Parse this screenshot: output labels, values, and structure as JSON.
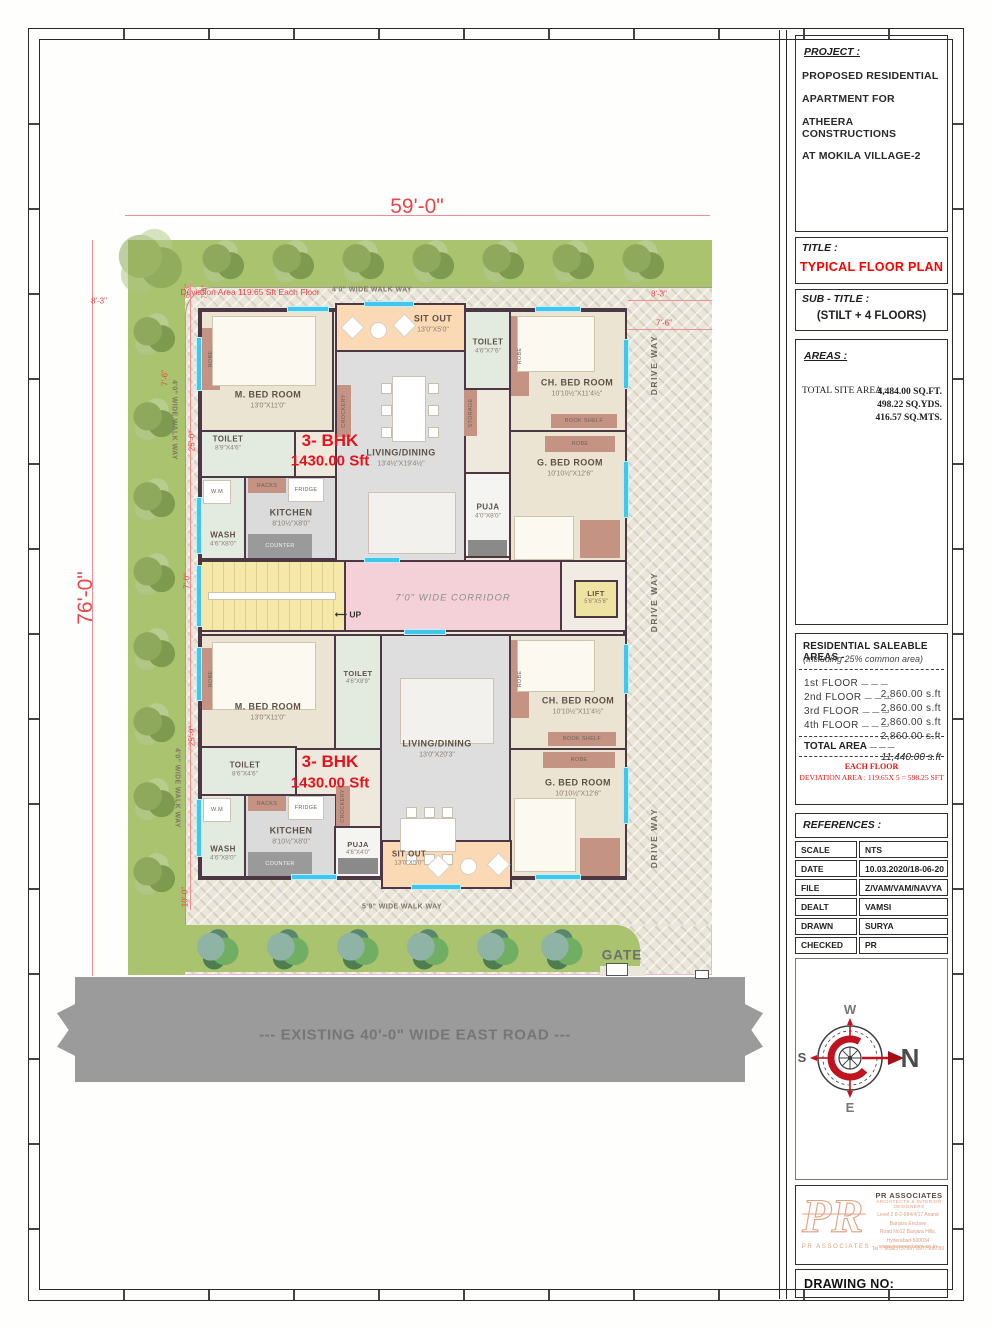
{
  "title_block": {
    "project": {
      "label": "PROJECT :",
      "lines": [
        "PROPOSED RESIDENTIAL",
        "APARTMENT FOR",
        "ATHEERA CONSTRUCTIONS",
        "AT  MOKILA VILLAGE-2"
      ]
    },
    "title": {
      "label": "TITLE :",
      "value": "TYPICAL FLOOR PLAN"
    },
    "subtitle": {
      "label": "SUB - TITLE :",
      "value": "(STILT + 4 FLOORS)"
    },
    "areas": {
      "label": "AREAS :",
      "row_label": "TOTAL SITE AREA :",
      "values": [
        "4,484.00 SQ.FT.",
        "498.22 SQ.YDS.",
        "416.57 SQ.MTS."
      ]
    },
    "saleable": {
      "heading": "RESIDENTIAL SALEABLE  AREAS  -",
      "subheading": "(Including 25% common area)",
      "rows": [
        {
          "floor": "1st   FLOOR",
          "dash": "— — —",
          "area": "2,860.00  s.ft"
        },
        {
          "floor": "2nd  FLOOR",
          "dash": "— — —",
          "area": "2,860.00  s.ft"
        },
        {
          "floor": "3rd  FLOOR",
          "dash": "— — —",
          "area": "2,860.00  s.ft"
        },
        {
          "floor": "4th  FLOOR",
          "dash": "— — —",
          "area": "2,860.00  s.ft"
        }
      ],
      "total_label": "TOTAL  AREA",
      "total_dash": "— — —",
      "total_area": "11,440.00  s.ft",
      "note1": "EACH FLOOR",
      "note2": "DEVIATION AREA  : 119.65X 5 = 598.25 SFT"
    },
    "references": {
      "label": "REFERENCES :",
      "rows": [
        {
          "k": "SCALE",
          "v": "NTS"
        },
        {
          "k": "DATE",
          "v": "10.03.2020/18-06-20"
        },
        {
          "k": "FILE",
          "v": "Z/VAM/VAM/NAVYA"
        },
        {
          "k": "DEALT",
          "v": "VAMSI"
        },
        {
          "k": "DRAWN",
          "v": "SURYA"
        },
        {
          "k": "CHECKED",
          "v": "PR"
        }
      ]
    },
    "compass": {
      "n": "N",
      "s": "S",
      "e": "E",
      "w": "W"
    },
    "firm": {
      "logo": "PR",
      "logo_caption": "PR ASSOCIATES",
      "name": "PR ASSOCIATES",
      "tagline": "ARCHITECTS & INTERIOR DESIGNERS",
      "addr1": "Level 2  8-2-684/4/17 Anand Banjara Enclave",
      "addr2": "Road No12 Banjara Hills, Hyderabad-500034",
      "addr3": "Tel :- 9032573789 / 8977506789",
      "web": "www.prassociates.co.in"
    },
    "drawing_no_label": "DRAWING NO:"
  },
  "plan": {
    "dims": {
      "overall_width": "59'-0\"",
      "overall_height": "76'-0\"",
      "top_inner": "42'-6\"",
      "left_8_3": "8'-3\"",
      "corner_8_3": "8'-3\"",
      "corner_7_6": "7'-6\"",
      "right_8_3": "8'-3\"",
      "right_7_6": "7'-6\"",
      "left_7_6": "7'-6\"",
      "left_25_0": "25'-0\"",
      "left_7_0": "7'-0\"",
      "left_25_9": "25'-9\"",
      "left_10_0": "10'-0\""
    },
    "notes": {
      "deviation": "Deviation Area 119.65 Sft Each Floor"
    },
    "labels": {
      "walkway_top": "4'0\" WIDE WALK WAY",
      "walkway_left": "4'0\" WIDE WALK WAY",
      "walkway_bottom": "5'9\" WIDE WALK WAY",
      "driveway": "DRIVE WAY",
      "gate": "GATE",
      "road": "--- EXISTING 40'-0\" WIDE EAST  ROAD ---"
    },
    "core": {
      "corridor": "7'0\" WIDE CORRIDOR",
      "up": "UP",
      "up_arrow": "⟵",
      "lift_name": "LIFT",
      "lift_dims": "5'6\"X5'6\""
    },
    "unit_upper": {
      "bhk": "3- BHK",
      "area": "1430.00 Sft",
      "m_bed": {
        "name": "M. BED ROOM",
        "dims": "13'0\"X11'0\""
      },
      "toilet": {
        "name": "TOILET",
        "dims": "8'9\"X4'6\""
      },
      "wash": {
        "name": "WASH",
        "dims": "4'6\"X8'0\""
      },
      "kitchen": {
        "name": "KITCHEN",
        "dims": "8'10½\"X8'0\""
      },
      "living": {
        "name": "LIVING/DINING",
        "dims": "13'4½\"X19'4½\""
      },
      "sitout": {
        "name": "SIT OUT",
        "dims": "13'0\"X5'0\""
      },
      "toilet2": {
        "name": "TOILET",
        "dims": "4'6\"X7'6\""
      },
      "puja": {
        "name": "PUJA",
        "dims": "4'0\"X8'0\""
      },
      "ch_bed": {
        "name": "CH. BED ROOM",
        "dims": "10'10½\"X11'4½\""
      },
      "g_bed": {
        "name": "G. BED ROOM",
        "dims": "10'10½\"X12'6\""
      }
    },
    "unit_lower": {
      "bhk": "3- BHK",
      "area": "1430.00 Sft",
      "m_bed": {
        "name": "M. BED ROOM",
        "dims": "13'0\"X11'0\""
      },
      "toilet_top": {
        "name": "TOILET",
        "dims": "4'6\"X8'9\""
      },
      "toilet": {
        "name": "TOILET",
        "dims": "8'6\"X4'6\""
      },
      "wash": {
        "name": "WASH",
        "dims": "4'6\"X8'0\""
      },
      "kitchen": {
        "name": "KITCHEN",
        "dims": "8'10½\"X8'0\""
      },
      "living": {
        "name": "LIVING/DINING",
        "dims": "13'0\"X20'3\""
      },
      "puja": {
        "name": "PUJA",
        "dims": "4'6\"X4'0\""
      },
      "sitout": {
        "name": "SIT OUT",
        "dims": "13'0\"X5'0\""
      },
      "ch_bed": {
        "name": "CH. BED ROOM",
        "dims": "10'10½\"X11'4½\""
      },
      "g_bed": {
        "name": "G. BED ROOM",
        "dims": "10'10½\"X12'6\""
      }
    },
    "fixtures": {
      "wm": "W.M",
      "racks": "RACKS",
      "fridge": "FRIDGE",
      "counter": "COUNTER",
      "crockery": "CROCKERY",
      "robe": "ROBE",
      "storage": "STORAGE",
      "book_shelf": "BOOK SHELF"
    }
  },
  "colors": {
    "dim_red": "#e8474b",
    "accent_red": "#ff0000",
    "wall": "#4b3844",
    "green": "#a9c36f",
    "road_gray": "#9b9b9b",
    "corridor_pink": "#f4d0d9",
    "sitout_peach": "#fbd9b4",
    "stairs_yellow": "#f5e8a8"
  }
}
